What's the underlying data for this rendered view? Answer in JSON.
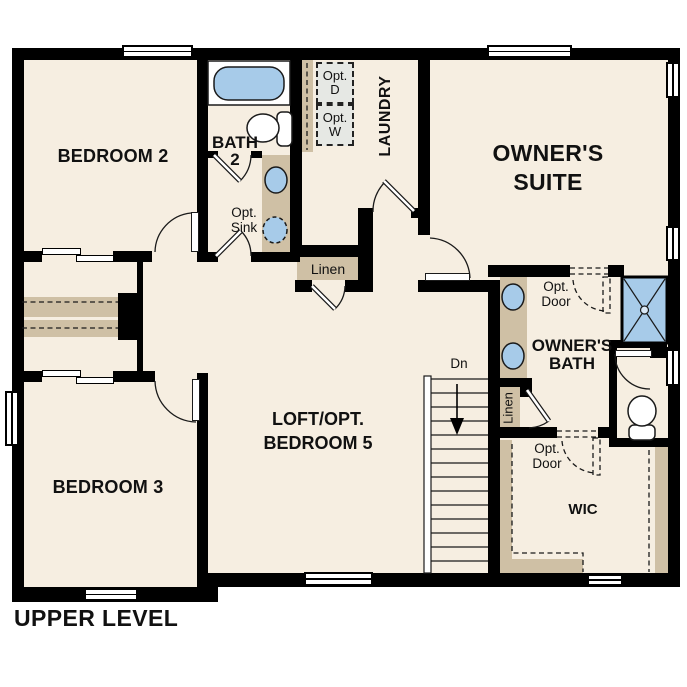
{
  "title": "UPPER LEVEL",
  "colors": {
    "wall": "#000000",
    "floor": "#f6eee1",
    "cabinet": "#cfc0a5",
    "fixture_blue": "#a7cbe9",
    "optional_gray": "#e6e8e4",
    "text": "#111111"
  },
  "rooms": {
    "bedroom2": {
      "label": "BEDROOM 2"
    },
    "bath2": {
      "label_line1": "BATH",
      "label_line2": "2",
      "opt_sink_line1": "Opt.",
      "opt_sink_line2": "Sink"
    },
    "laundry": {
      "label": "LAUNDRY",
      "opt_dryer_line1": "Opt.",
      "opt_dryer_line2": "D",
      "opt_washer_line1": "Opt.",
      "opt_washer_line2": "W"
    },
    "owners_suite": {
      "label_line1": "OWNER'S",
      "label_line2": "SUITE"
    },
    "hall_linen": {
      "label": "Linen"
    },
    "owners_bath": {
      "label_line1": "OWNER'S",
      "label_line2": "BATH",
      "opt_door_line1": "Opt.",
      "opt_door_line2": "Door",
      "linen_label": "Linen"
    },
    "loft": {
      "label_line1": "LOFT/OPT.",
      "label_line2": "BEDROOM 5"
    },
    "stairs": {
      "label": "Dn"
    },
    "bedroom3": {
      "label": "BEDROOM 3"
    },
    "wic": {
      "label": "WIC",
      "opt_door_line1": "Opt.",
      "opt_door_line2": "Door"
    }
  }
}
